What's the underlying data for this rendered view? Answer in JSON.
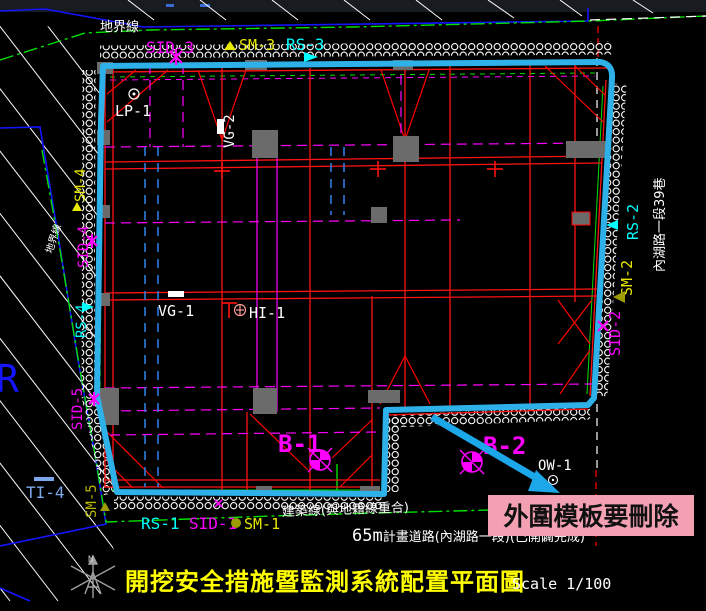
{
  "labels": {
    "boundary_top": "地界線",
    "boundary_left": "地界線",
    "sid3": "SID-3",
    "sm3": "SM-3",
    "rs3": "RS-3",
    "lp1": "LP-1",
    "vg2": "VG-2",
    "sm4": "SM-4",
    "sid4": "SID-4",
    "rs4": "RS-4",
    "sid5": "SID-5",
    "sm5": "SM-5",
    "ti4": "TI-4",
    "vg1": "VG-1",
    "hi1": "HI-1",
    "b1": "B-1",
    "b2": "B-2",
    "ow1": "OW-1",
    "rs2": "RS-2",
    "sm2": "SM-2",
    "sid2": "SID-2",
    "road_right": "內湖路一段39巷",
    "rs1": "RS-1",
    "sid1": "SID-1",
    "sm1": "SM-1",
    "building_line": "建築線(與地籍線重合)",
    "road_bottom_prefix": "65m",
    "road_bottom": "計畫道路(內湖路一段)(已開闢完成)",
    "parcel_text": "R",
    "callout": "外圍模板要刪除",
    "title": "開挖安全措施暨監測系統配置平面圖",
    "scale": "Scale 1/100",
    "north": "N"
  },
  "colors": {
    "boundary": "#2eb0e8",
    "callout_bg": "#f2a0b2",
    "strut_red": "#ff1212",
    "centerline_magenta": "#ff00ff",
    "label_cyan": "#00ffff",
    "label_yellow": "#e8e800",
    "label_olive": "#9c9c00",
    "property_green": "#00e000",
    "parcel_blue": "#1414ff",
    "interior_blue": "#2f7bdf",
    "ti_blue": "#7aa8ea",
    "column_grey": "#6b6b6b",
    "title_yellow": "#ffff00"
  }
}
